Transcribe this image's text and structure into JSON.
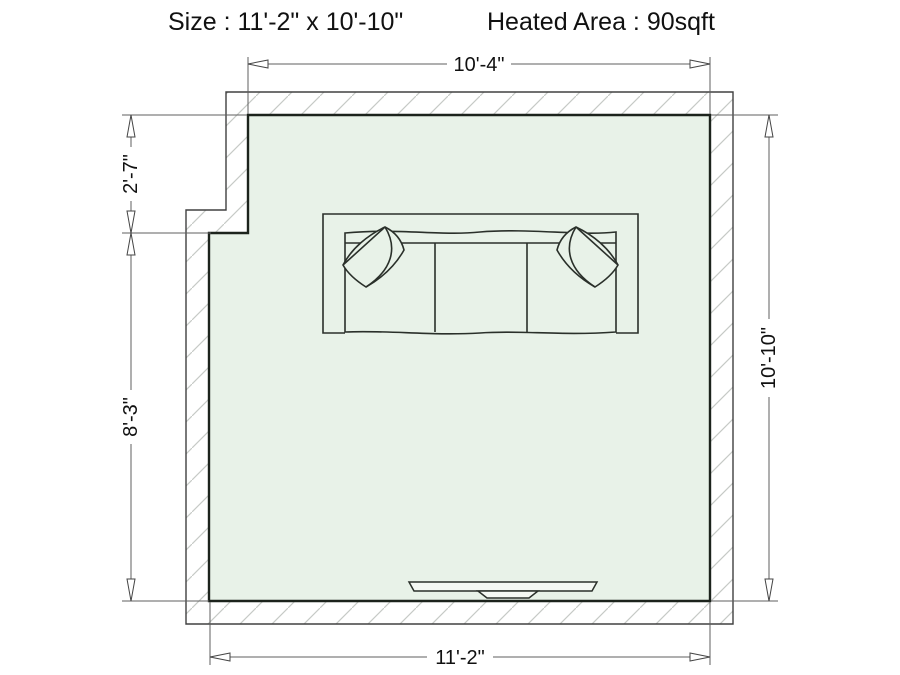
{
  "header": {
    "size_label": "Size : 11'-2\" x 10'-10\"",
    "heated_area_label": "Heated Area : 90sqft"
  },
  "dimensions": {
    "top_width": "10'-4\"",
    "left_upper_height": "2'-7\"",
    "left_lower_height": "8'-3\"",
    "right_height": "10'-10\"",
    "bottom_width": "11'-2\""
  },
  "room": {
    "type": "floor-plan",
    "size": "11'-2\" x 10'-10\"",
    "heated_area": "90sqft",
    "floor_color": "#e8f2e8",
    "wall_line_color": "#1c231c",
    "hatch_color": "#c6cac6",
    "dimension_line_color": "#5f5f5f",
    "furniture": [
      "sofa-with-two-pillows",
      "tv"
    ]
  }
}
